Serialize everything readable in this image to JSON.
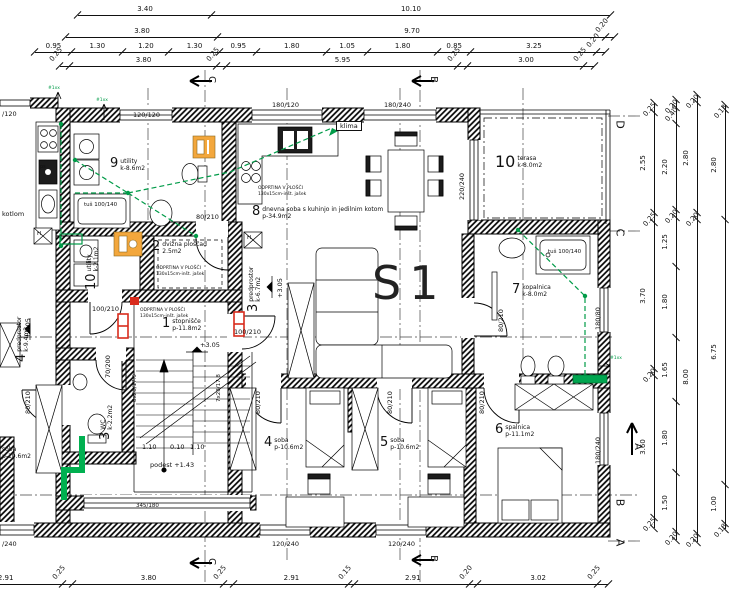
{
  "apartment_label": "S1",
  "rooms": [
    {
      "num": "9",
      "name": "utility",
      "area": "k-8.6m2"
    },
    {
      "num": "8",
      "name": "dnevna soba s kuhinjo in jedilnim kotom",
      "area": "p-34.9m2"
    },
    {
      "num": "10",
      "name": "terasa",
      "area": "k-8.0m2"
    },
    {
      "num": "7",
      "name": "kopalnica",
      "area": "k-8.0m2"
    },
    {
      "num": "2",
      "name": "dvižna ploščad",
      "area": "2.5m2"
    },
    {
      "num": "3",
      "name": "predprostor",
      "area": "k-6.7m2"
    },
    {
      "num": "1",
      "name": "stopnišče",
      "area": "p-11.8m2"
    },
    {
      "num": "3",
      "name": "WC",
      "area": "k-2.2m2"
    },
    {
      "num": "4",
      "name": "soba",
      "area": "p-10.6m2"
    },
    {
      "num": "5",
      "name": "soba",
      "area": "p-10.6m2"
    },
    {
      "num": "6",
      "name": "spalnica",
      "area": "p-11.1m2"
    },
    {
      "num": "10",
      "name": "utility",
      "area": "k-2.1m2"
    },
    {
      "num": "4",
      "name": "predprostor",
      "area": "k-9.4m2"
    },
    {
      "num": "",
      "name": "soba",
      "area": "p-10.6m2"
    }
  ],
  "openings": {
    "w120120": "120/120",
    "w180120": "180/120",
    "w180240": "180/240",
    "w220240": "220/240",
    "w120240": "120/240",
    "w18080": "180/80",
    "wpart240": "/240",
    "wpart120": "/120",
    "d80210": "80/210",
    "d100210": "100/210",
    "d70200": "70/200",
    "o345180": "345/180",
    "tus": "tuš 100/140"
  },
  "annotations": {
    "klima": "klima",
    "odprtina1": "ODPRTINA V PLOŠČI",
    "odprtina2": "130x15cm-inšt. jašek",
    "level305": "+3.05",
    "podest": "podest +1.43",
    "stair8": "8x28/17.9",
    "stair7": "7x28/17.8",
    "dim110a": "1.10",
    "dim010": "0.10",
    "dim110b": "1.10",
    "kotlom": "kotlom",
    "ps": "ps",
    "h": "H",
    "hash": "#1xx"
  },
  "axes": {
    "d": "D",
    "c": "C",
    "b": "B",
    "a": "A",
    "sec_c": "C",
    "sec_b": "B",
    "sec_a": "A"
  },
  "dimensions": {
    "top1": {
      "values": [
        "3.40",
        "10.10"
      ]
    },
    "top2": {
      "values": [
        "3.80",
        "9.70",
        "0.20"
      ]
    },
    "top3": {
      "values": [
        "0.95",
        "1.30",
        "1.20",
        "1.30",
        "0.95",
        "1.80",
        "1.05",
        "1.80",
        "0.85",
        "3.25",
        "0.20"
      ]
    },
    "top4": {
      "values": [
        "0.25",
        "3.80",
        "0.25",
        "5.95",
        "0.25",
        "3.00",
        "0.25"
      ]
    },
    "bottom1": {
      "values": [
        "2.91",
        "0.25",
        "3.80",
        "0.25",
        "2.91",
        "0.15",
        "2.91",
        "0.20",
        "3.02",
        "0.25"
      ]
    },
    "right1": {
      "values": [
        "0.25",
        "2.55",
        "0.25",
        "3.70",
        "0.20",
        "3.60",
        "0.25"
      ]
    },
    "right2": {
      "values": [
        "0.20",
        "0.40",
        "2.20",
        "0.20",
        "1.25",
        "1.80",
        "1.65",
        "1.80",
        "1.50",
        "0.20"
      ]
    },
    "right3": {
      "values": [
        "0.20",
        "2.80",
        "0.20",
        "8.00",
        "0.20"
      ]
    },
    "right4": {
      "values": [
        "0.13",
        "2.80",
        "6.75",
        "1.00",
        "0.13"
      ]
    }
  },
  "colors": {
    "install_green": "#009B48",
    "pipe_green": "#00B050",
    "cabinet_yellow": "#F3A73C",
    "alarm_red": "#D92B1C",
    "wall": "#000000"
  }
}
